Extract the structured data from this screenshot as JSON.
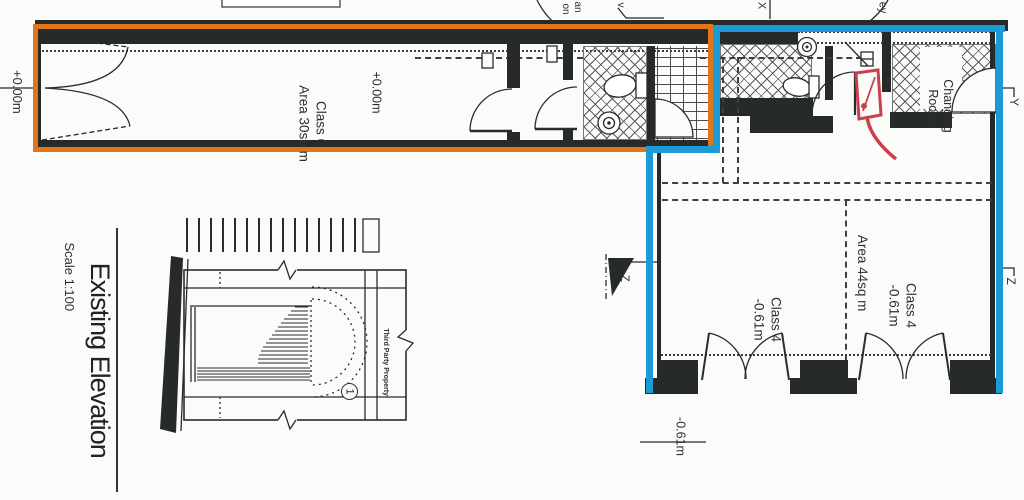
{
  "plan": {
    "datum_left": "+0.00m",
    "class6_name": "Class 6",
    "class6_area": "Area 30sq m",
    "class6_level": "+0.00m",
    "changing_room_line1": "Changing",
    "changing_room_line2": "Room",
    "class4_left_name": "Class 4",
    "class4_left_level": "-0.61m",
    "class4_area": "Area 44sq m",
    "class4_right_name": "Class 4",
    "class4_right_level": "-0.61m",
    "datum_bottom": "-0.61m"
  },
  "elevation": {
    "title": "Existing Elevation",
    "scale": "Scale 1:100",
    "third_party": "Third Party Property",
    "ref": "1"
  },
  "markers": {
    "x": "X",
    "y": "Y",
    "z_left": "Z",
    "z_right": "Z"
  },
  "fragments": {
    "an": "an",
    "on": "on",
    "v": "v.",
    "ey": "ey"
  },
  "colors": {
    "highlight_orange": "#e0751c",
    "highlight_blue": "#1b9ad6",
    "annotation_red": "#c8414b",
    "wall_dark": "#262b29"
  }
}
